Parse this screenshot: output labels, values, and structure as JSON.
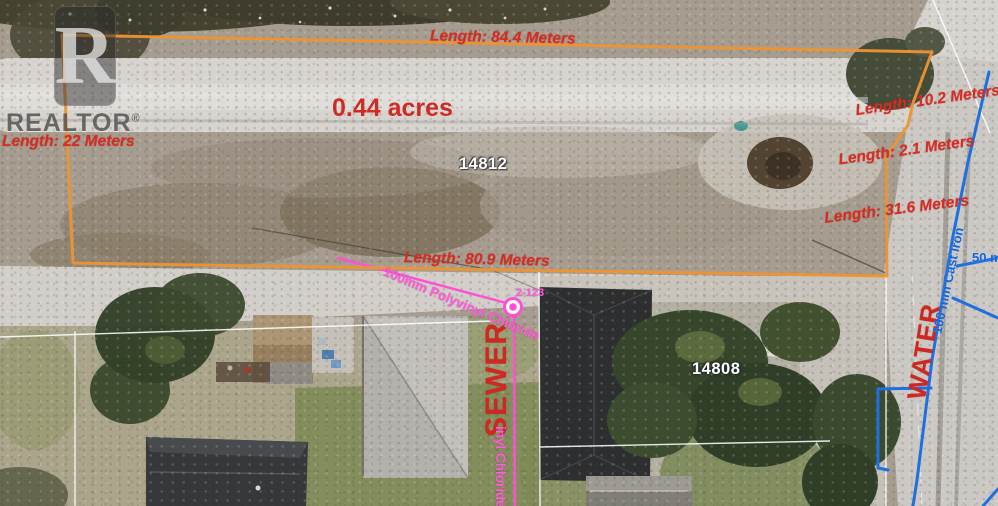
{
  "watermark": {
    "block_letter": "R",
    "brand": "REALTOR",
    "registered_mark": "®"
  },
  "parcel": {
    "area_label": "0.44 acres",
    "parcel_number": "14812",
    "adjacent_parcel_number": "14808",
    "measurements": {
      "top": "Length: 84.4 Meters",
      "left": "Length: 22 Meters",
      "right_upper": "Length: 10.2 Meters",
      "right_middle": "Length: 2.1 Meters",
      "right_lower": "Length: 31.6 Meters",
      "bottom": "Length: 80.9 Meters"
    },
    "colors": {
      "boundary": "#ee9433",
      "measurement_text": "#d92b22"
    }
  },
  "utilities": {
    "sewer": {
      "name": "SEWER",
      "pipe_label": "100mm Polyvinyl Chloride",
      "pipe_label_visible_fragment": "inyl Chloride",
      "node_id": "2-123",
      "colors": {
        "line": "#ff4fd4",
        "name_text": "#cf2722",
        "pipe_text": "#ff5fd8"
      }
    },
    "water": {
      "name": "WATER",
      "pipe_label": "100 mm Cast Iron",
      "scale_label": "50 m",
      "colors": {
        "line": "#1f6fe0",
        "name_text": "#cf2722",
        "pipe_text": "#1565d8"
      }
    }
  }
}
